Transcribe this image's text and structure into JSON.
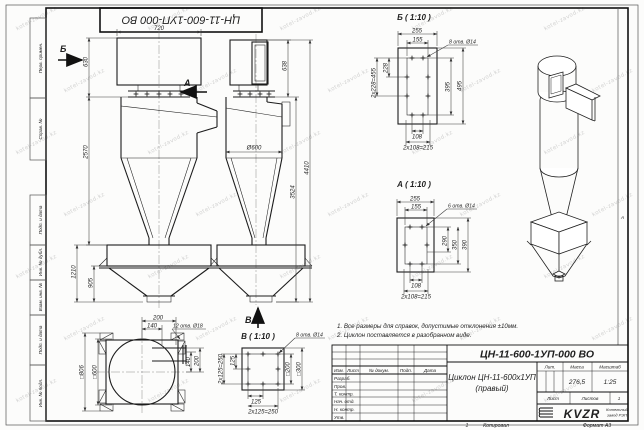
{
  "stamp": {
    "doc_number_rotated": "ЦН-11-600-1УП-000 ВО"
  },
  "watermark": {
    "text": "kotel-zavod.kz"
  },
  "frame": {
    "left_labels": [
      "Перв. примен.",
      "Справ. №",
      "Подп. и дата",
      "Инв. № дубл.",
      "Взам. инв. №",
      "Подп. и дата",
      "Инв. № подл."
    ],
    "zone_letter": "А",
    "copy_num": "1",
    "copy_label": "Копировал",
    "format_label": "Формат А3"
  },
  "front_view": {
    "arrow_b": "Б",
    "arrow_a": "А",
    "dim_720": "720",
    "dim_630": "630",
    "dim_2570": "2570",
    "dim_1210": "1210",
    "dim_905": "905"
  },
  "side_view": {
    "dim_dia": "Ø600",
    "dim_638": "638",
    "dim_3524": "3524",
    "dim_4410": "4410",
    "arrow_v": "В"
  },
  "top_view": {
    "callout": "12 отв. Ø18",
    "dim_200": "200",
    "dim_140": "140",
    "dim_r140": "140",
    "dim_r200": "200",
    "dim_sq806": "□806",
    "dim_sq600": "□600"
  },
  "detail_b": {
    "title": "Б ( 1:10 )",
    "callout": "8 отв. Ø14",
    "dim_255": "255",
    "dim_155": "155",
    "dim_228": "228",
    "dim_2x228": "2х228=455",
    "dim_395": "395",
    "dim_495": "495",
    "dim_108": "108",
    "dim_2x108": "2х108=215"
  },
  "detail_a": {
    "title": "А ( 1:10 )",
    "callout": "6 отв. Ø14",
    "dim_255": "255",
    "dim_155": "155",
    "dim_290": "290",
    "dim_350": "350",
    "dim_390": "390",
    "dim_108": "108",
    "dim_2x108": "2х108=215"
  },
  "detail_v": {
    "title": "В ( 1:10 )",
    "callout": "8 отв. Ø14",
    "dim_125l": "125",
    "dim_2x125l": "2х125=250",
    "dim_sq200": "□200",
    "dim_sq300": "□300",
    "dim_125b": "125",
    "dim_2x125b": "2х125=250"
  },
  "notes": {
    "line1": "1. Все размеры для справок, допустимые отклонения ±10мм.",
    "line2": "2. Циклон поставляется в разобранном виде."
  },
  "title_block": {
    "doc_number": "ЦН-11-600-1УП-000 ВО",
    "name_line1": "Циклон ЦН-11-600х1УП",
    "name_line2": "(правый)",
    "col_izm": "Изм.",
    "col_list": "Лист",
    "col_doc": "№ докум.",
    "col_podp": "Подп.",
    "col_data": "Дата",
    "row_razrab": "Разраб.",
    "row_prov": "Пров.",
    "row_tkontr": "Т. контр.",
    "row_nachotd": "Нач. отд.",
    "row_nkontr": "Н. контр.",
    "row_utv": "Утв.",
    "lit_label": "Лит.",
    "mass_label": "Масса",
    "scale_label": "Масштаб",
    "mass_value": "276,5",
    "scale_value": "1:25",
    "sheet_label": "Лист",
    "sheets_label": "Листов",
    "sheets_value": "1",
    "logo_text": "KVZR",
    "logo_sub1": "Котельный",
    "logo_sub2": "завод РЭП"
  }
}
